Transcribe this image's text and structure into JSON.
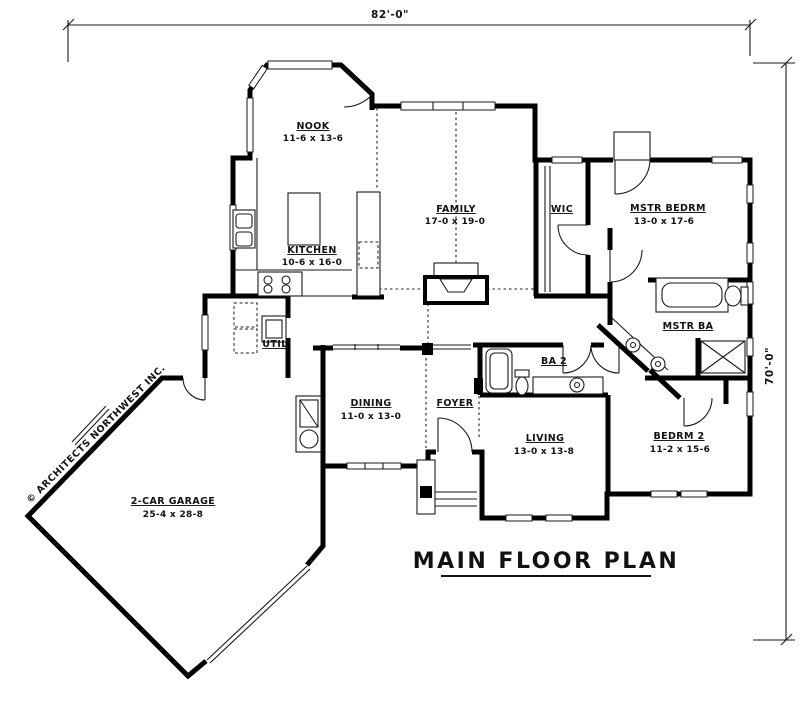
{
  "plan": {
    "title": "MAIN FLOOR PLAN",
    "copyright": "© ARCHITECTS NORTHWEST INC.",
    "overall_dimensions": {
      "width": "82'-0\"",
      "height": "70'-0\""
    },
    "rooms": {
      "nook": {
        "name": "NOOK",
        "size": "11-6 x 13-6"
      },
      "kitchen": {
        "name": "KITCHEN",
        "size": "10-6 x 16-0"
      },
      "family": {
        "name": "FAMILY",
        "size": "17-0 x 19-0"
      },
      "wic": {
        "name": "WIC",
        "size": ""
      },
      "master_bedroom": {
        "name": "MSTR BEDRM",
        "size": "13-0 x 17-6"
      },
      "master_bath": {
        "name": "MSTR BA",
        "size": ""
      },
      "utility": {
        "name": "UTIL",
        "size": ""
      },
      "bath2": {
        "name": "BA 2",
        "size": ""
      },
      "dining": {
        "name": "DINING",
        "size": "11-0 x 13-0"
      },
      "foyer": {
        "name": "FOYER",
        "size": ""
      },
      "living": {
        "name": "LIVING",
        "size": "13-0 x 13-8"
      },
      "bedroom2": {
        "name": "BEDRM 2",
        "size": "11-2 x 15-6"
      },
      "garage": {
        "name": "2-CAR GARAGE",
        "size": "25-4 x 28-8"
      }
    },
    "colors": {
      "ink": "#111111",
      "paper": "#ffffff"
    }
  }
}
